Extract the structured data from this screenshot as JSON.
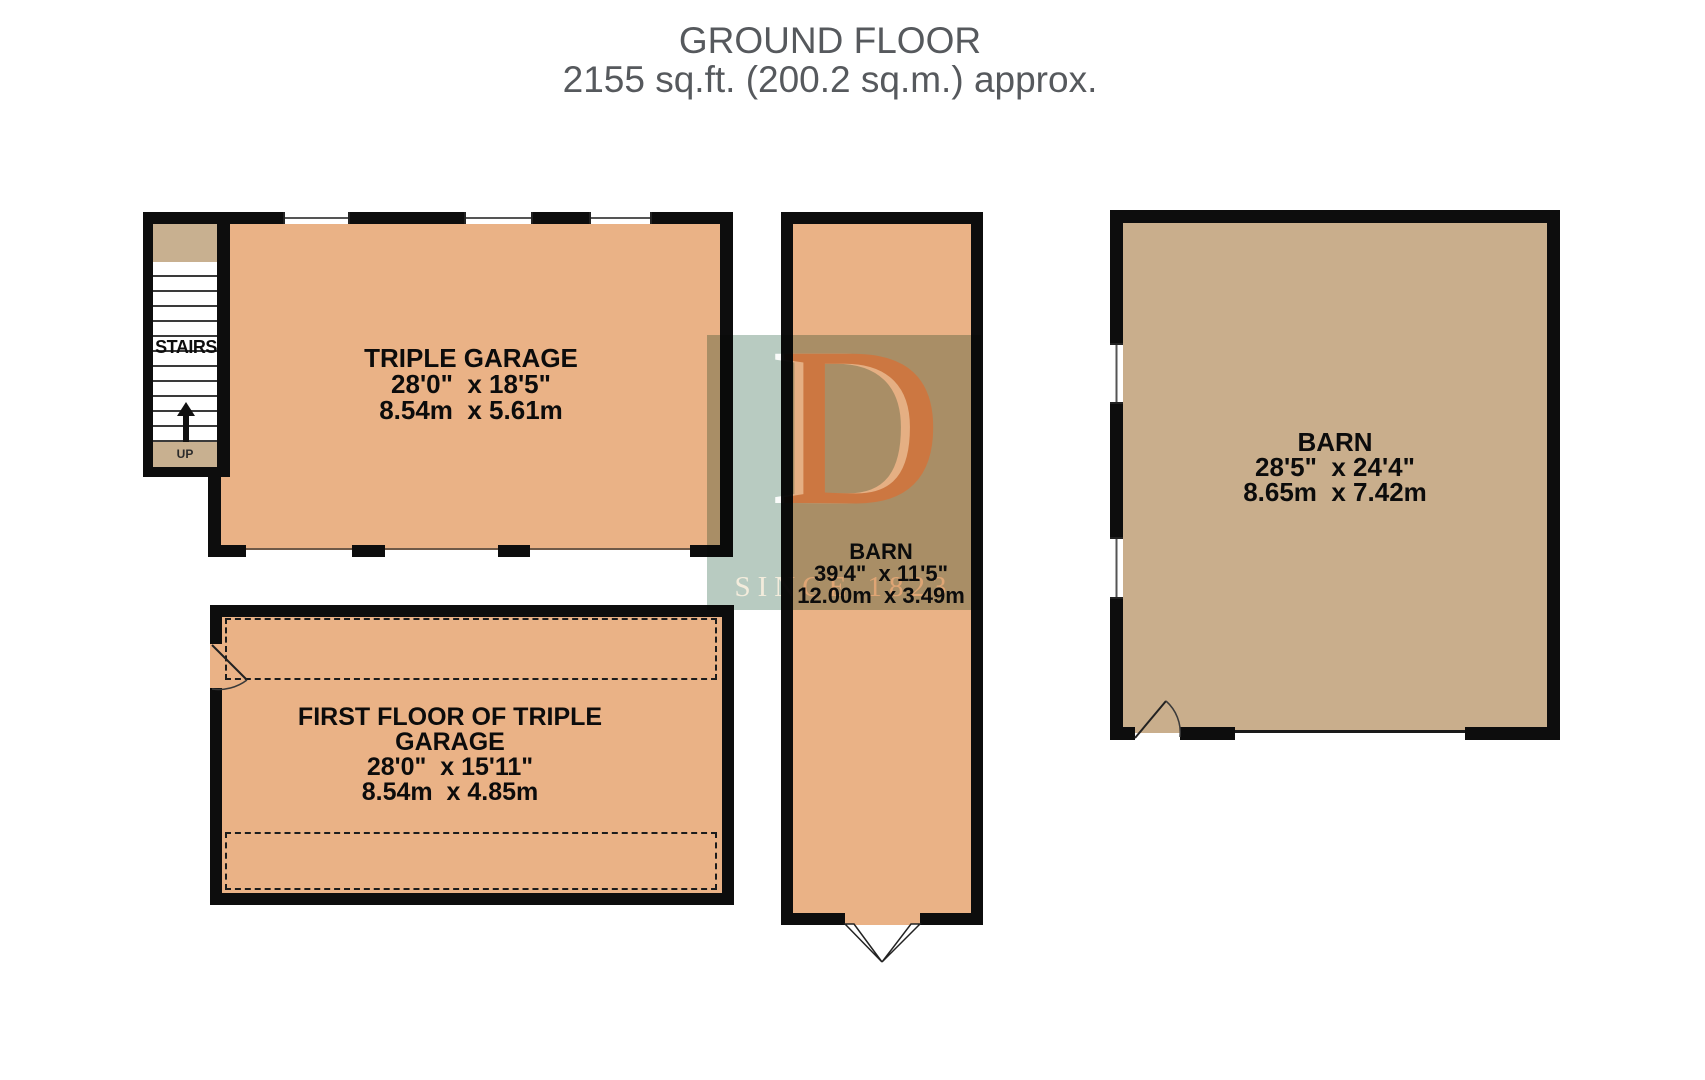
{
  "title": {
    "line1": "GROUND FLOOR",
    "line2": "2155 sq.ft. (200.2 sq.m.) approx."
  },
  "rooms": {
    "triple_garage": {
      "name": "TRIPLE GARAGE",
      "dims_imperial": "28'0\"  x 18'5\"",
      "dims_metric": "8.54m  x 5.61m"
    },
    "first_floor_garage": {
      "name": "FIRST FLOOR OF TRIPLE GARAGE",
      "dims_imperial": "28'0\"  x 15'11\"",
      "dims_metric": "8.54m  x 4.85m"
    },
    "barn_middle": {
      "name": "BARN",
      "dims_imperial": "39'4\"  x 11'5\"",
      "dims_metric": "12.00m  x 3.49m"
    },
    "barn_right": {
      "name": "BARN",
      "dims_imperial": "28'5\"  x 24'4\"",
      "dims_metric": "8.65m  x 7.42m"
    }
  },
  "stairs": {
    "label": "STAIRS",
    "up_label": "UP"
  },
  "watermark": {
    "letter": "D",
    "caption": "SINCE 1823"
  },
  "colors": {
    "room_orange": "#eab286",
    "barn_khaki": "#c9ae8c",
    "stair_tan": "#c8b090",
    "wall_black": "#0d0d0d",
    "title_gray": "#56595d",
    "watermark_sage": "#b8cbc1",
    "watermark_letter_orange": "#dfab7c"
  }
}
